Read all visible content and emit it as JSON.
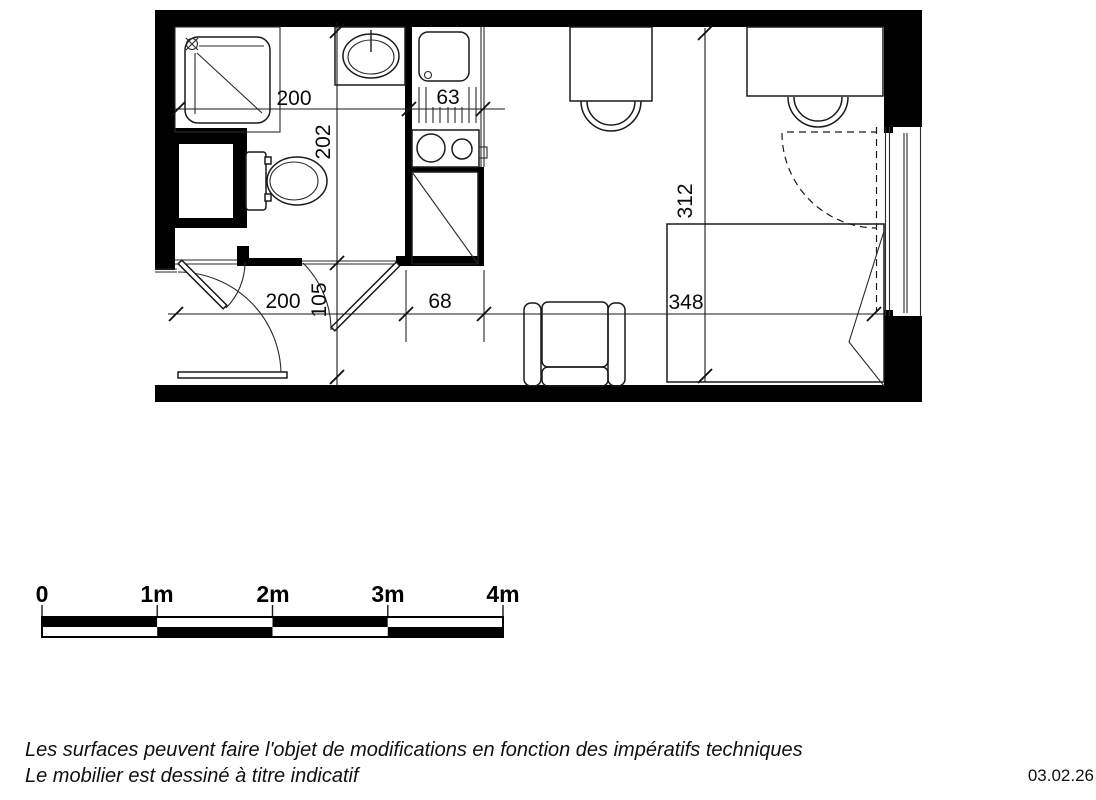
{
  "dimensions": {
    "bathroom_width_cm": "200",
    "kitchen_width_cm": "63",
    "bathroom_depth_cm": "202",
    "hallway_depth_cm": "105",
    "entry_width_cm": "200",
    "kitchen_passage_cm": "68",
    "living_width_cm": "348",
    "living_depth_cm": "312"
  },
  "scale_bar": {
    "labels": [
      "0",
      "1m",
      "2m",
      "3m",
      "4m"
    ]
  },
  "footnotes": {
    "line1": "Les surfaces peuvent faire l'objet de modifications en fonction des impératifs techniques",
    "line2": "Le mobilier est dessiné à titre indicatif"
  },
  "date": "03.02.26",
  "colors": {
    "ink": "#1a1a1a",
    "wall": "#000000",
    "background": "#ffffff"
  }
}
